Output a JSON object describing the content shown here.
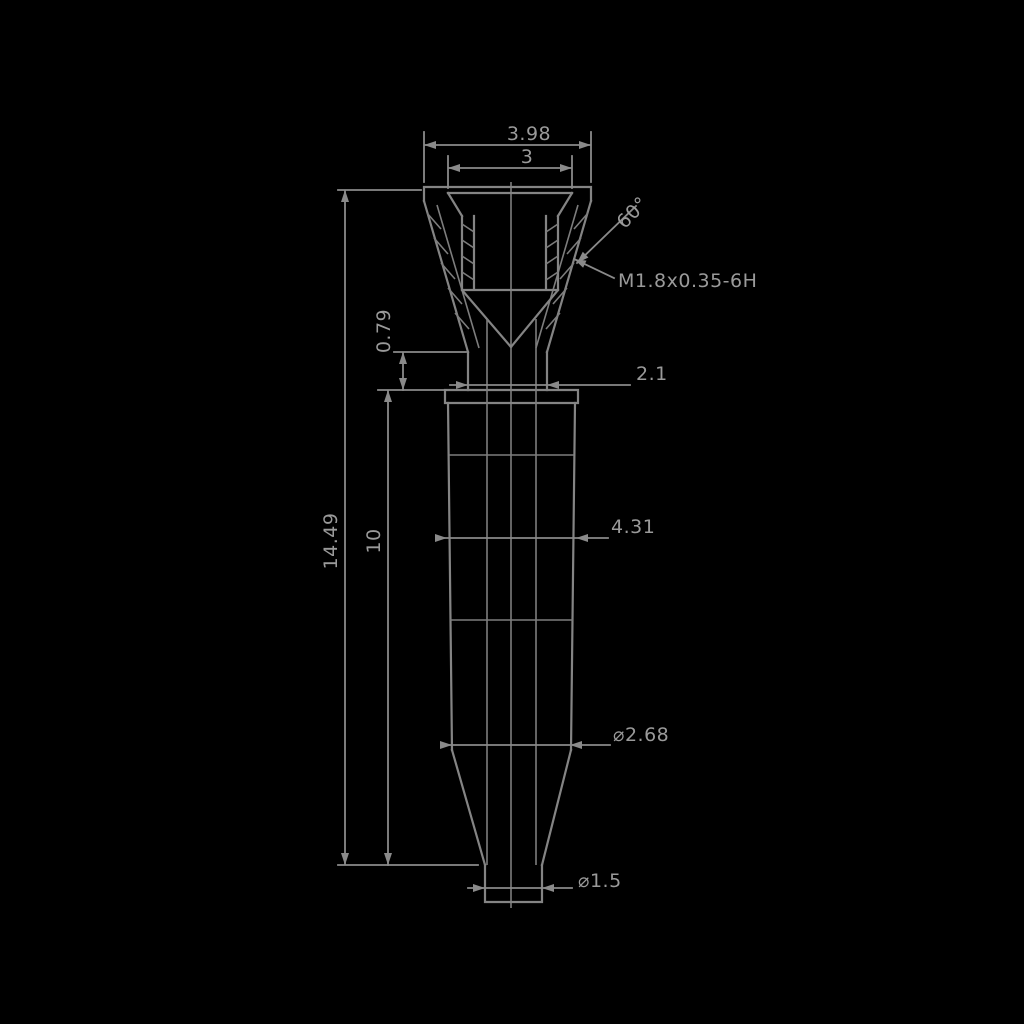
{
  "drawing": {
    "background": "#000000",
    "line_color": "#848484",
    "text_color": "#9a9a9a",
    "dimensions": {
      "overall_width": "3.98",
      "bore_width": "3",
      "cone_angle": "60°",
      "thread_callout": "M1.8x0.35-6H",
      "neck_height": "0.79",
      "neck_width": "2.1",
      "body_width": "4.31",
      "lower_diameter": "⌀2.68",
      "tip_diameter": "⌀1.5",
      "overall_length": "14.49",
      "body_length": "10"
    }
  }
}
